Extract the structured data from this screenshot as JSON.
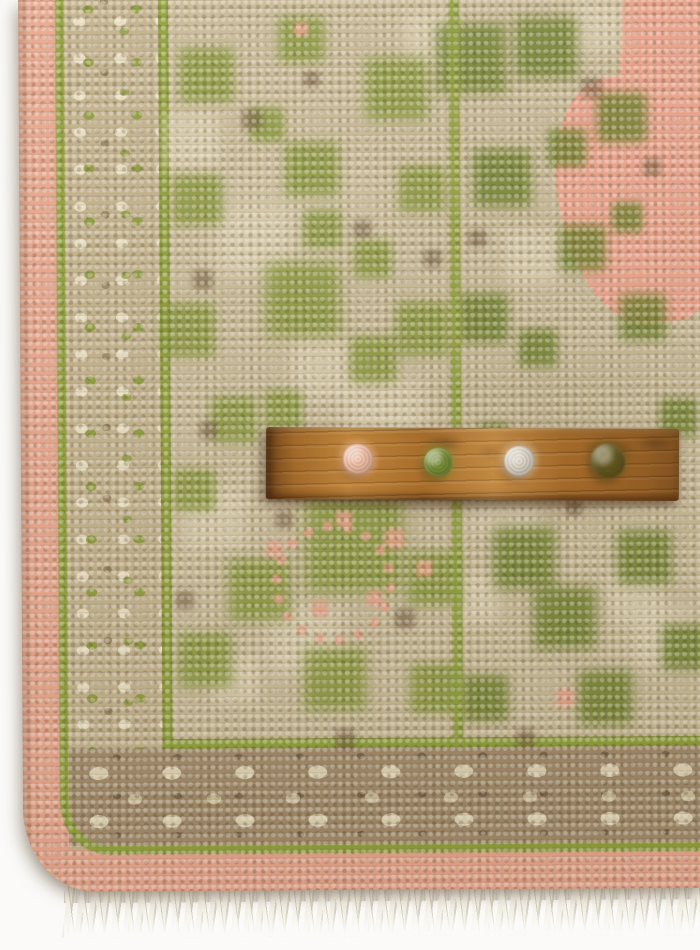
{
  "scene": {
    "description": "Close-up of the corner of a hand-knotted wool rug in beige, olive green and blush pink, photographed from above on a white background. A wooden yarn colour-sample stick holding four wool pom-poms lies across the rug, and an ivory tassel fringe runs along the bottom edge.",
    "background_color": "#fbfaf8"
  },
  "rug": {
    "name": "hand-knotted-rug-corner",
    "colors": {
      "outer_band_pink": "#e8a68c",
      "guard_stripe_olive": "#8fa03a",
      "minor_border_beige": "#c2b18b",
      "lower_border_taupe": "#a18a69",
      "main_border_beige": "#c9ba96",
      "motif_green": "#829430",
      "accent_brown": "#6e5638",
      "field_pink": "#eda48c",
      "fringe_ivory": "#efece2"
    },
    "features": [
      "blush pink outer band wrapping a rounded bottom-left corner",
      "olive green guard stripes",
      "beige minor border with small green and brown rosettes",
      "wide main border with green foliate motifs on beige",
      "pink rosette outline in the lower border",
      "blush pink field with dark olive vines in the upper right",
      "ivory cotton tassel fringe along the bottom edge"
    ]
  },
  "sample_stick": {
    "name": "wooden-yarn-sample-stick",
    "wood_color": "#b0752f",
    "pom_poms": [
      {
        "name": "blush-pink-wool",
        "color": "#f2c0a6"
      },
      {
        "name": "moss-green-wool",
        "color": "#7b9038"
      },
      {
        "name": "ivory-wool",
        "color": "#dcd4c6"
      },
      {
        "name": "dark-olive-wool",
        "color": "#64581f"
      }
    ]
  }
}
